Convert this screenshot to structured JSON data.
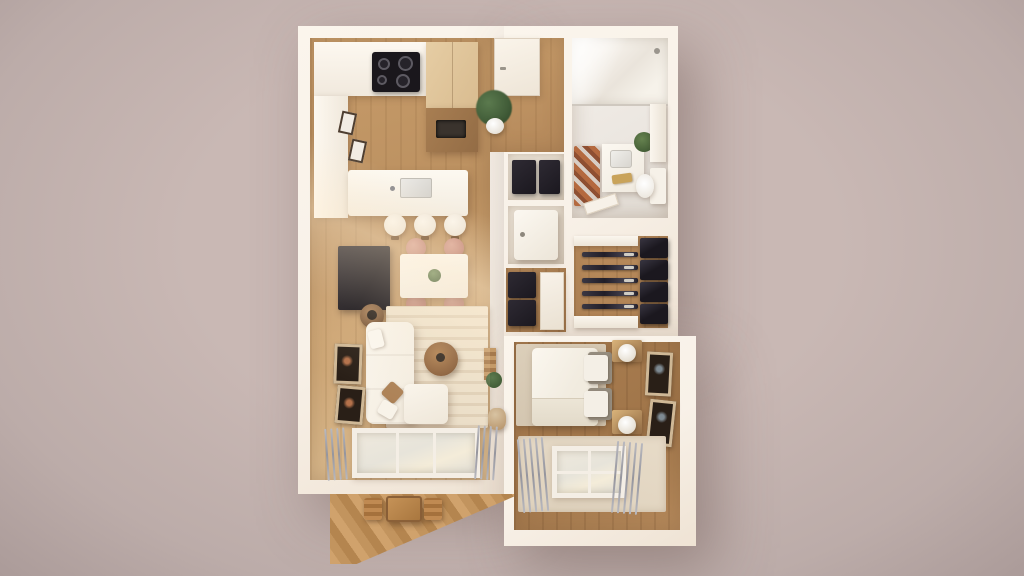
{
  "scene": {
    "type": "architectural-3d-render",
    "view": "top-down cutaway floor plan of a one-bedroom apartment",
    "style": "photoreal dollhouse render on plain mauve backdrop"
  },
  "palette": {
    "background": "#c9b8b4",
    "wall": "#f8f1e8",
    "wood_floor": "#bb9060",
    "wood_bedroom": "#a07549",
    "wood_closet": "#ad8154",
    "wood_balcony": "#c2945e",
    "tile_bath": "#ebe6e0",
    "rug_living": "#e9dcc6",
    "rug_bedroom": "#dfd2bd",
    "rug_bath": "#b4693f",
    "rug_bath_alt": "#d8cdc4",
    "sofa": "#f3ecdf",
    "bed": "#f1ebdf",
    "chair_rose": "#c4887a",
    "tv": "#17141a",
    "cooktop": "#1a171c",
    "cabinet_wood": "#d9bc90",
    "cabinet_wood_dark": "#936c45",
    "dark_storage": "#1b181f",
    "plant": "#415c38",
    "glass": "#e7e4da",
    "curtain": "#95959d",
    "accent_brass": "#c9a35a"
  },
  "rooms": {
    "kitchen": {
      "label": "Kitchen",
      "items": [
        "wall counter",
        "induction cooktop",
        "tall wood cabinet",
        "lower wood unit with sink",
        "side counter",
        "island with sink",
        "three bar stools",
        "two small wall frames",
        "potted plant"
      ]
    },
    "entry": {
      "label": "Entry hall",
      "items": [
        "front door",
        "potted plant"
      ]
    },
    "dining": {
      "label": "Dining area",
      "items": [
        "white dining table",
        "four rose chairs",
        "table plant"
      ]
    },
    "living": {
      "label": "Living room",
      "items": [
        "wall TV",
        "striped rug",
        "L-shaped white sofa",
        "round coffee table",
        "round side basket",
        "throw pillows",
        "two wall artworks",
        "decor ladder",
        "plant",
        "basket",
        "balcony window",
        "curtains"
      ]
    },
    "bathroom": {
      "label": "Bathroom",
      "items": [
        "walk-in shower",
        "chevron rug",
        "vanity with sink",
        "brass towel",
        "plant",
        "toilet",
        "tall cabinet",
        "door"
      ]
    },
    "storage": {
      "label": "Storage niches",
      "items": [
        "dark shelf niche",
        "washing machine niche"
      ]
    },
    "hallway": {
      "label": "Hallway",
      "items": [
        "shoe shelves",
        "door"
      ]
    },
    "closet": {
      "label": "Walk-in closet",
      "items": [
        "hanging rails with clothes",
        "four dark shelf boxes",
        "white shelves"
      ]
    },
    "bedroom": {
      "label": "Bedroom",
      "items": [
        "double bed with white duvet",
        "gray and white pillows",
        "two wood nightstands",
        "two white lamps",
        "two wall artworks",
        "beige rug",
        "window with curtains"
      ]
    },
    "balcony": {
      "label": "Balcony",
      "items": [
        "plank deck",
        "bistro table",
        "two chairs"
      ]
    }
  }
}
